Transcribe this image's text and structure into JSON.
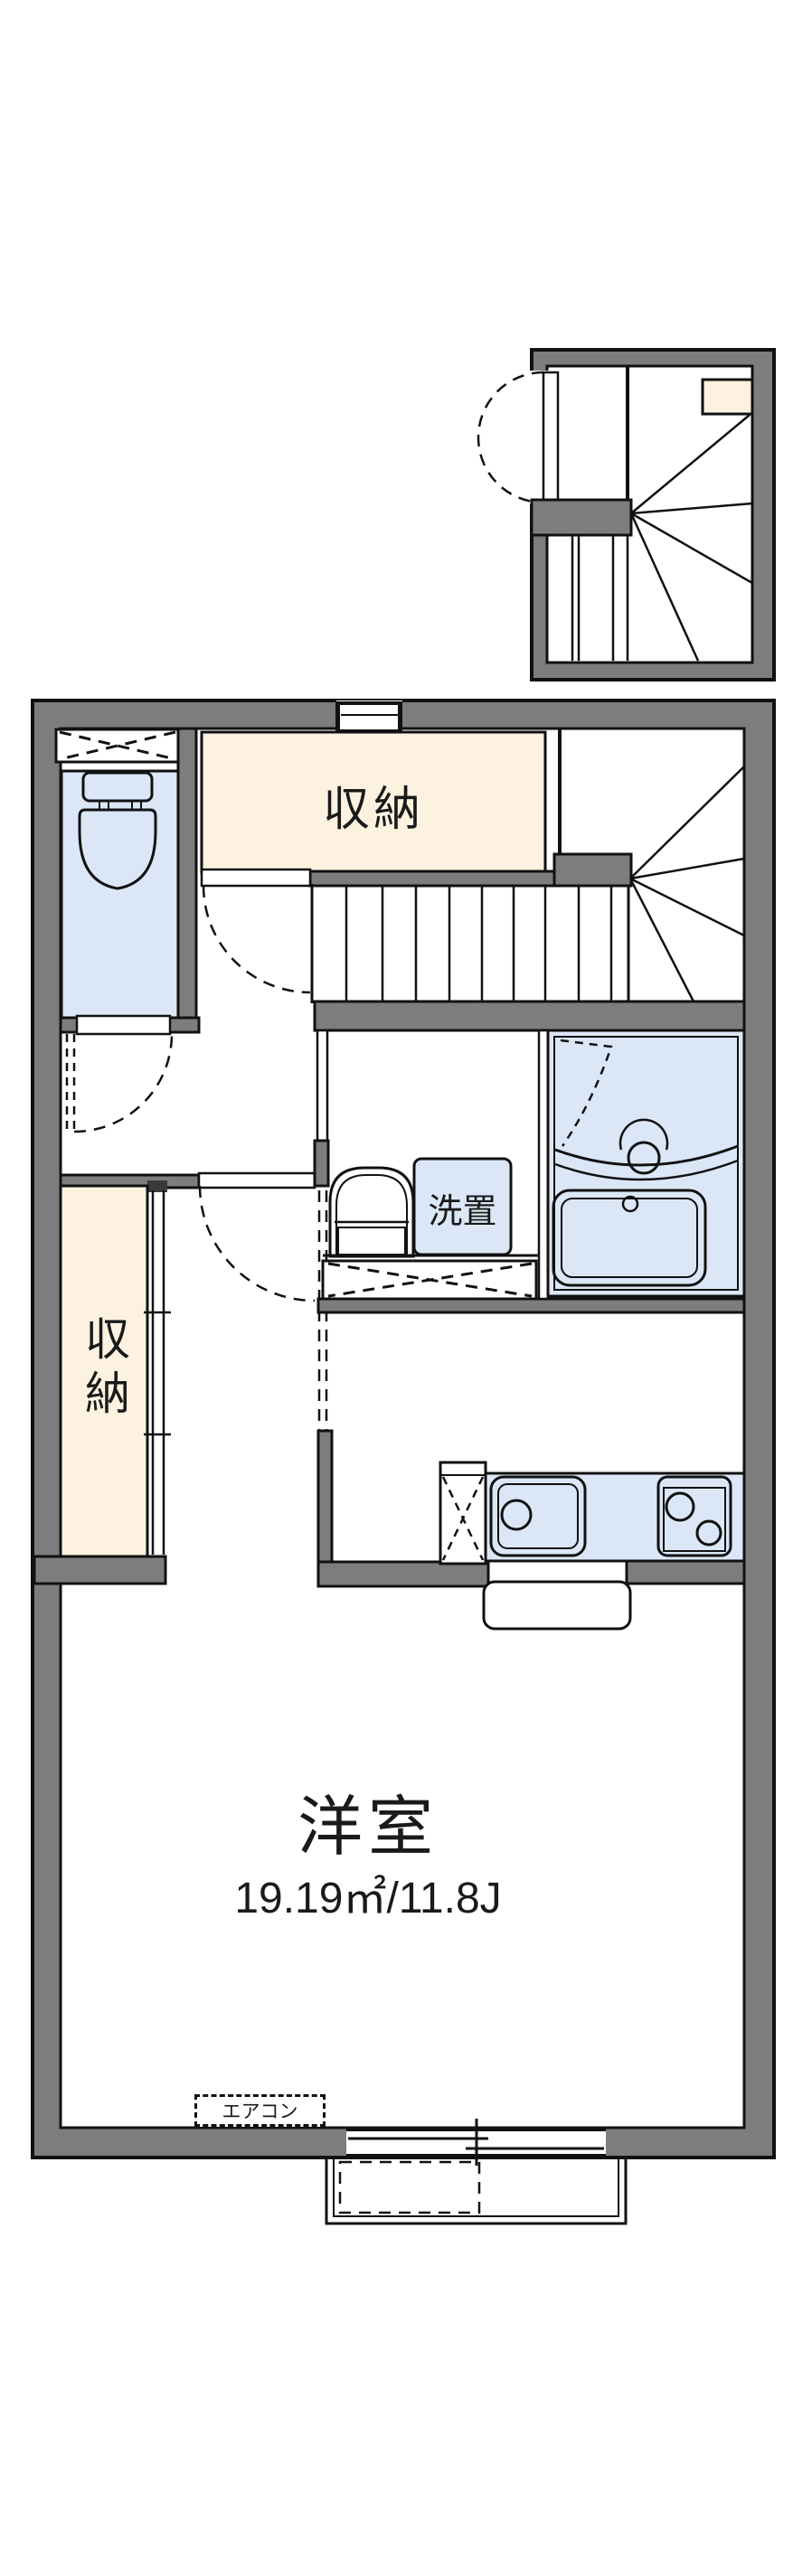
{
  "floorplan": {
    "labels": {
      "closet_top": "収納",
      "closet_side": "収納",
      "laundry": "洗置",
      "room_name": "洋室",
      "room_area": "19.19㎡/11.8J",
      "aircon": "エアコン"
    },
    "colors": {
      "wall_gray": "#7d7d7d",
      "closet_cream": "#fcf2df",
      "fixture_blue": "#dbe7f7",
      "line_black": "#111111",
      "background": "#ffffff"
    }
  }
}
